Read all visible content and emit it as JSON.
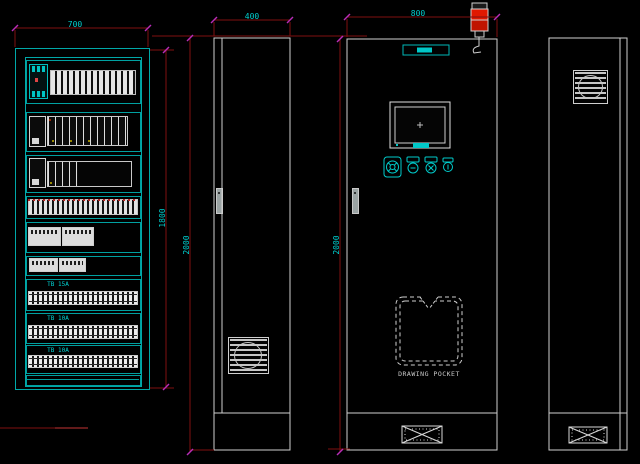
{
  "app": {
    "type": "cad-drawing",
    "subject": "electrical control cabinet general-arrangement drawing"
  },
  "colors": {
    "background": "#000000",
    "cad_cyan": "#00a8a8",
    "cad_cyan_bright": "#00d4d4",
    "dimension_line_red": "#7f0f0f",
    "dimension_arrow_magenta": "#b92db9",
    "dimension_text_cyan": "#00cfcf",
    "outline_white": "#cfcfcf",
    "alarm_lamp_red": "#e01800"
  },
  "views": {
    "interior_layout": {
      "width_dim": "700",
      "height_dim": "1800",
      "terminal_strips": [
        {
          "label": "TB 15A"
        },
        {
          "label": "TB 10A"
        },
        {
          "label": "TB 10A"
        }
      ]
    },
    "side": {
      "width_dim": "400",
      "height_dim": "2000"
    },
    "front": {
      "width_dim": "800",
      "height_dim": "2000",
      "pocket_label": "DRAWING POCKET"
    },
    "rear": {}
  },
  "icons": {
    "signal_tower": "stack-light",
    "fan_louver": "square louver with fan circle",
    "gland_plate": "rectangle with X cross and bolt dots",
    "door_handle": "vertical bar with pin",
    "emergency_stop": "round mushroom button",
    "pushbutton": "round button with tag plate",
    "drawing_pocket": "dashed pocket with V notch",
    "hmi_panel": "touch screen with frame"
  }
}
